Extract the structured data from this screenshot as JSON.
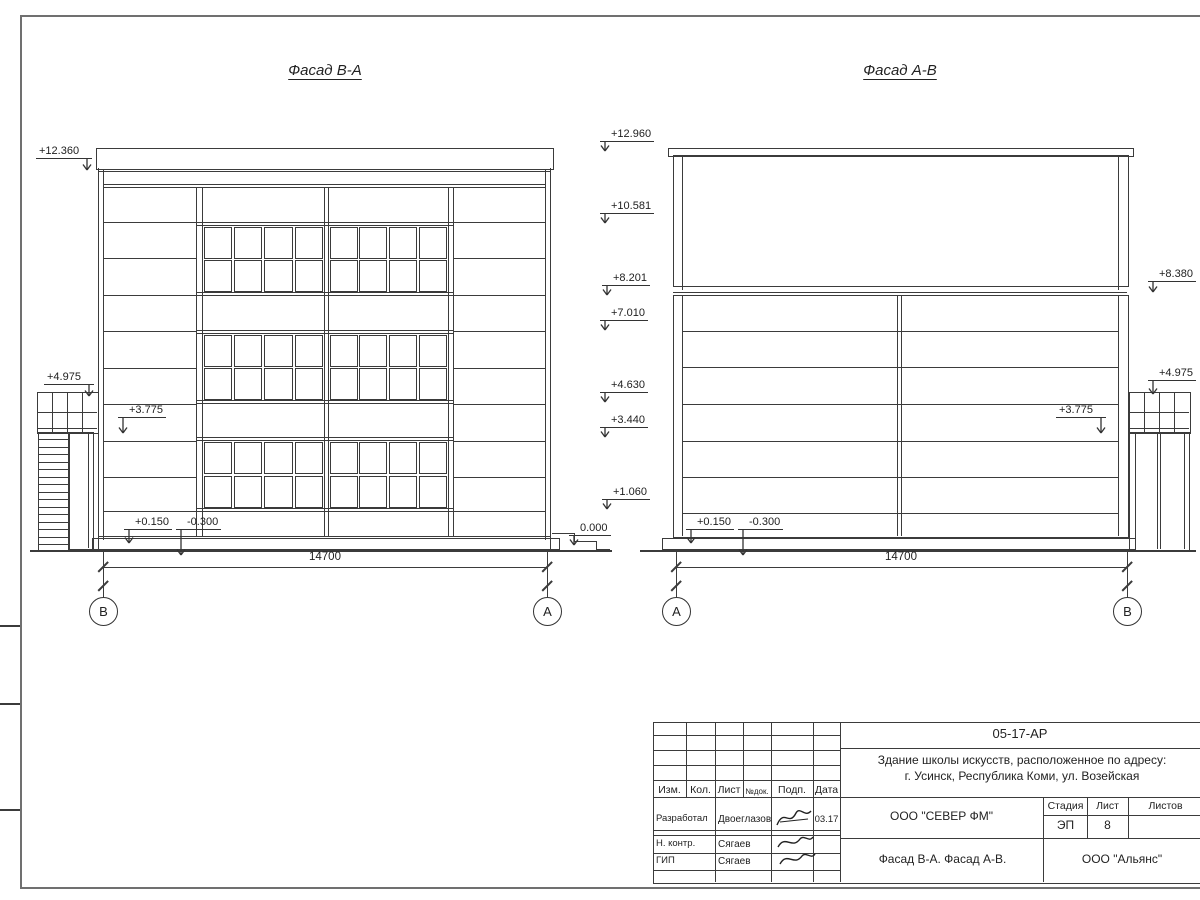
{
  "left_view": {
    "title": "Фасад В-А",
    "marks": [
      "+12.360",
      "+4.975",
      "+3.775",
      "+0.150",
      "-0.300",
      "0.000"
    ],
    "dimension": "14700",
    "axes": [
      "В",
      "А"
    ]
  },
  "levels_column": [
    "+12.960",
    "+10.581",
    "+8.201",
    "+7.010",
    "+4.630",
    "+3.440",
    "+1.060"
  ],
  "right_view": {
    "title": "Фасад А-В",
    "marks": [
      "+8.380",
      "+4.975",
      "+3.775",
      "+0.150",
      "-0.300"
    ],
    "dimension": "14700",
    "axes": [
      "А",
      "В"
    ]
  },
  "title_block": {
    "doc_number": "05-17-АР",
    "project_line1": "Здание школы искусств, расположенное по адресу:",
    "project_line2": "г. Усинск, Республика Коми, ул. Возейская",
    "columns": [
      "Изм.",
      "Кол.",
      "Лист",
      "№док.",
      "Подп.",
      "Дата"
    ],
    "rows": [
      {
        "role": "Разработал",
        "name": "Двоеглазов",
        "date": "03.17"
      },
      {
        "role": "Н. контр.",
        "name": "Сягаев",
        "date": ""
      },
      {
        "role": "ГИП",
        "name": "Сягаев",
        "date": ""
      }
    ],
    "designer_company": "ООО \"СЕВЕР ФМ\"",
    "stage_label": "Стадия",
    "sheet_label": "Лист",
    "sheets_label": "Листов",
    "stage_value": "ЭП",
    "sheet_value": "8",
    "sheet_title": "Фасад В-А. Фасад А-В.",
    "contractor": "ООО \"Альянс\""
  }
}
